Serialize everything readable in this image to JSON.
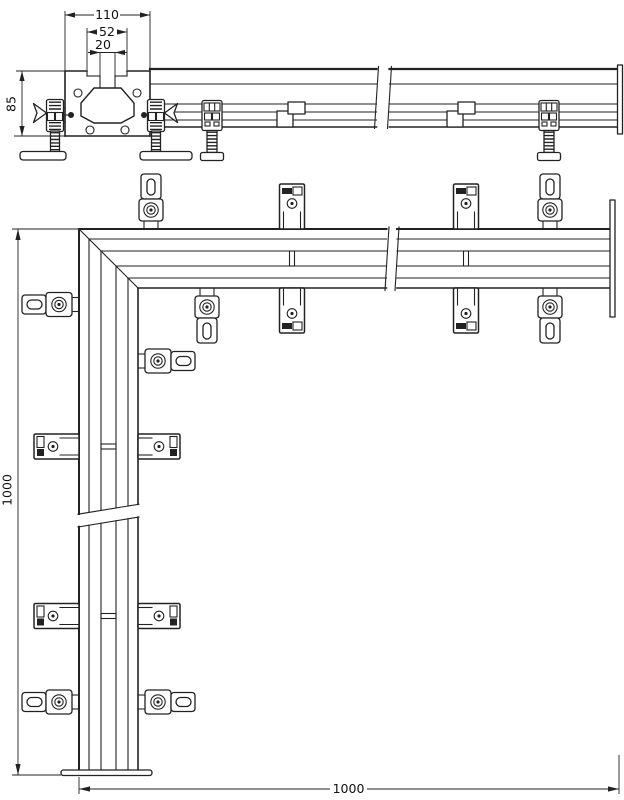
{
  "drawing": {
    "title": "rail-corner-installation-drawing",
    "dims": {
      "w110": "110",
      "w52": "52",
      "w20": "20",
      "h85": "85",
      "len_left": "1000",
      "len_bottom": "1000"
    },
    "colors": {
      "line": "#222222",
      "background": "#ffffff"
    }
  }
}
